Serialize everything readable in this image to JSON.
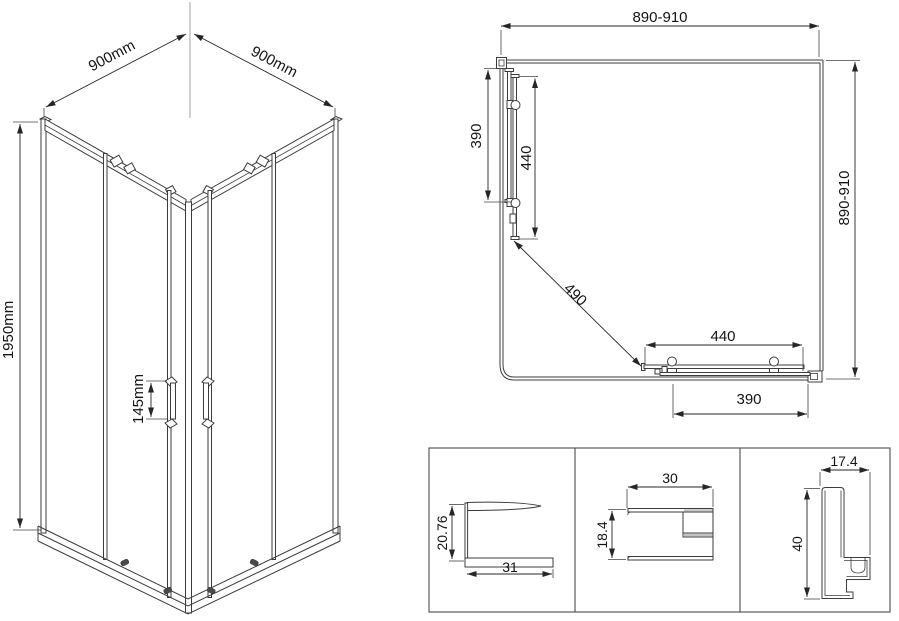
{
  "colors": {
    "line": "#3c3c3c",
    "dimension": "#262626",
    "text": "#141414",
    "background": "#ffffff"
  },
  "iso_view": {
    "width_left_label": "900mm",
    "width_right_label": "900mm",
    "height_label": "1950mm",
    "handle_spacing_label": "145mm"
  },
  "plan_view": {
    "top_width_label": "890-910",
    "right_depth_label": "890-910",
    "left_fixed_panel_label": "390",
    "left_door_label": "440",
    "diagonal_opening_label": "490",
    "bottom_door_label": "440",
    "bottom_fixed_panel_label": "390"
  },
  "profiles": {
    "wall_profile_height": "20.76",
    "wall_profile_width": "31",
    "rail_profile_width": "30",
    "rail_profile_height": "18.4",
    "track_profile_width": "17.4",
    "track_profile_height": "40"
  }
}
